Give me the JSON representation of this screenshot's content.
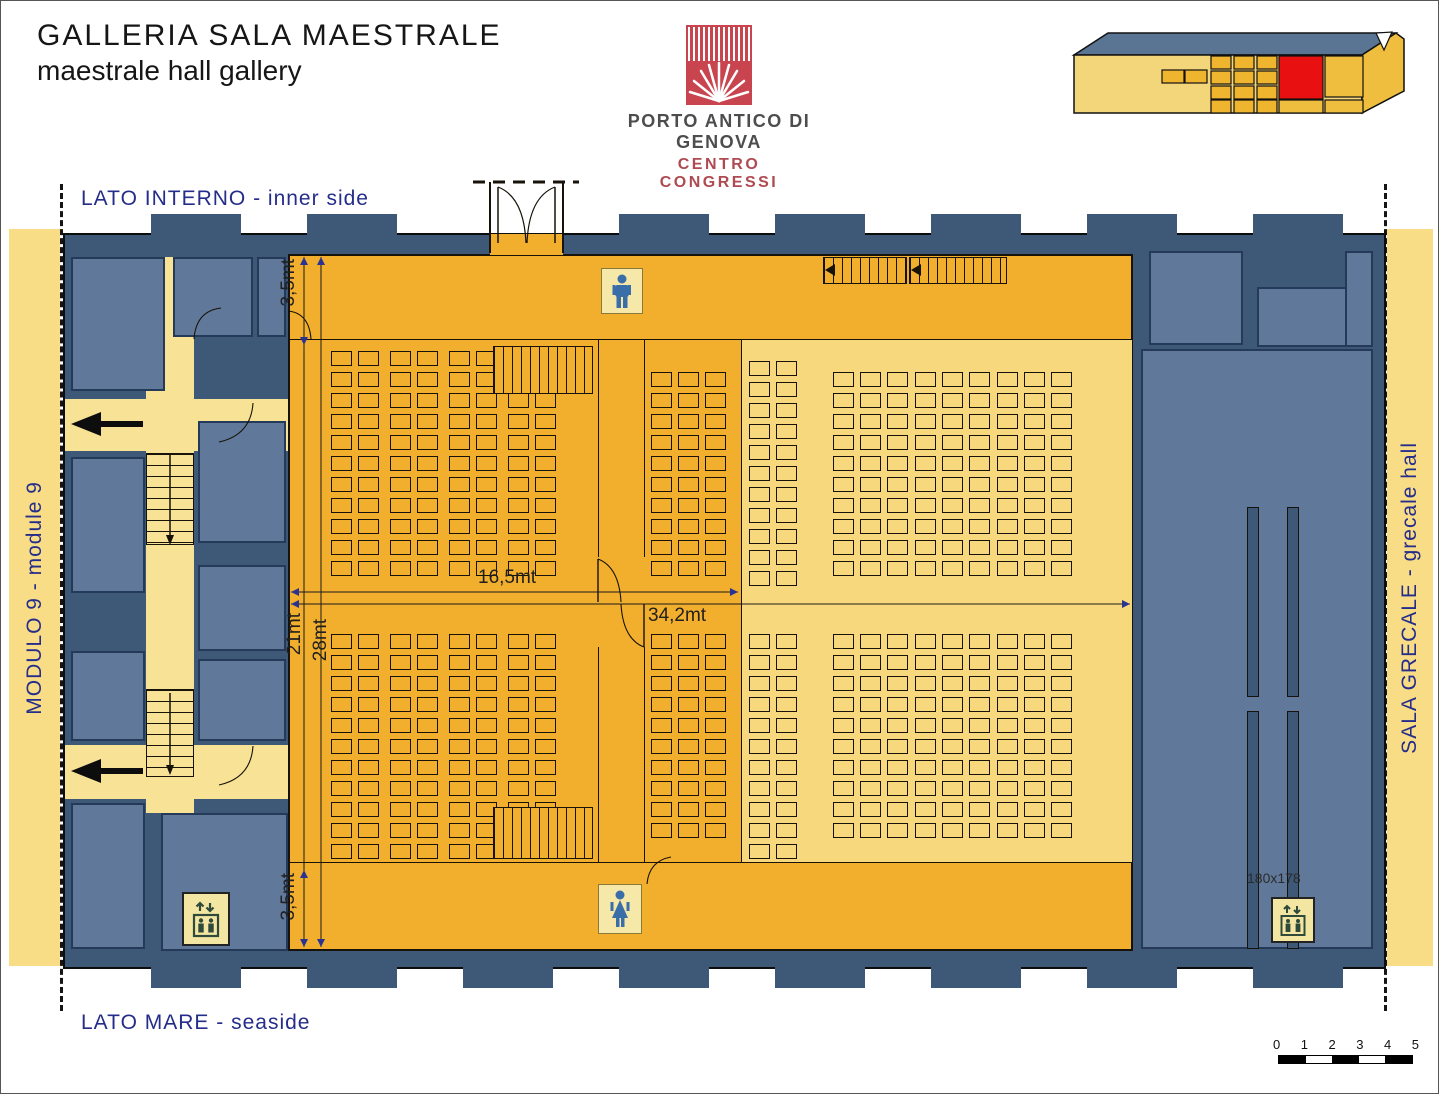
{
  "header": {
    "title": "GALLERIA SALA MAESTRALE",
    "subtitle": "maestrale hall gallery",
    "logo_line1": "PORTO ANTICO DI GENOVA",
    "logo_line2": "CENTRO CONGRESSI"
  },
  "labels": {
    "top": "LATO INTERNO - inner side",
    "bottom": "LATO MARE - seaside",
    "left": "MODULO 9 - module 9",
    "right": "SALA GRECALE - grecale hall"
  },
  "dims": {
    "top35": "3,5mt",
    "h21": "21mt",
    "h28": "28mt",
    "w165": "16,5mt",
    "w342": "34,2mt",
    "bottom35": "3,5mt",
    "elevator": "180x178"
  },
  "scalebar": {
    "ticks": [
      "0",
      "1",
      "2",
      "3",
      "4",
      "5"
    ]
  },
  "colors": {
    "wall": "#3E5878",
    "room": "#60789A",
    "hall_orange": "#F2AF2E",
    "seating_light": "#F8D87D",
    "side_strip": "#F8DC86",
    "corridor_yellow": "#F8E296",
    "label_navy": "#252D8A",
    "logo_red": "#C8444F",
    "logo_text_red": "#AF4A52",
    "locator_highlight_red": "#E81010",
    "roof_blue": "#5A7494",
    "wc_figure_blue": "#3A6EA8"
  },
  "icons": {
    "men_wc": "man silhouette in yellow box",
    "women_wc": "woman silhouette in yellow box",
    "elevator": "up-down arrows above cabin with two figures",
    "exit_arrow": "thick black arrow pointing left",
    "stairs": "hatched run with direction arrow",
    "logo_mark": "red square with white stripes and starburst",
    "building_locator": "isometric building with red highlighted module"
  },
  "floorplan": {
    "seat_blocks": [
      {
        "cols": [
          330,
          357,
          389,
          416,
          448,
          475,
          507,
          534
        ],
        "y": 350,
        "count": 11,
        "pitch": 21,
        "w": 21,
        "h": 15,
        "fill": "#F2AF2E"
      },
      {
        "cols": [
          650,
          677,
          704
        ],
        "y": 371,
        "count": 10,
        "pitch": 21,
        "w": 21,
        "h": 15,
        "fill": "#F2AF2E"
      },
      {
        "cols": [
          330,
          357,
          389,
          416,
          448,
          475,
          507,
          534
        ],
        "y": 633,
        "count": 11,
        "pitch": 21,
        "w": 21,
        "h": 15,
        "fill": "#F2AF2E"
      },
      {
        "cols": [
          650,
          677,
          704
        ],
        "y": 633,
        "count": 10,
        "pitch": 21,
        "w": 21,
        "h": 15,
        "fill": "#F2AF2E"
      },
      {
        "cols": [
          748,
          775
        ],
        "y": 360,
        "count": 11,
        "pitch": 21,
        "w": 21,
        "h": 15,
        "fill": "#F8D87D"
      },
      {
        "cols": [
          832,
          859,
          886
        ],
        "y": 371,
        "count": 10,
        "pitch": 21,
        "w": 21,
        "h": 15,
        "fill": "#F8D87D"
      },
      {
        "cols": [
          914,
          941,
          968
        ],
        "y": 371,
        "count": 10,
        "pitch": 21,
        "w": 21,
        "h": 15,
        "fill": "#F8D87D"
      },
      {
        "cols": [
          996,
          1023,
          1050
        ],
        "y": 371,
        "count": 10,
        "pitch": 21,
        "w": 21,
        "h": 15,
        "fill": "#F8D87D"
      },
      {
        "cols": [
          748,
          775
        ],
        "y": 633,
        "count": 11,
        "pitch": 21,
        "w": 21,
        "h": 15,
        "fill": "#F8D87D"
      },
      {
        "cols": [
          832,
          859,
          886
        ],
        "y": 633,
        "count": 10,
        "pitch": 21,
        "w": 21,
        "h": 15,
        "fill": "#F8D87D"
      },
      {
        "cols": [
          914,
          941,
          968
        ],
        "y": 633,
        "count": 10,
        "pitch": 21,
        "w": 21,
        "h": 15,
        "fill": "#F8D87D"
      },
      {
        "cols": [
          996,
          1023,
          1050
        ],
        "y": 633,
        "count": 10,
        "pitch": 21,
        "w": 21,
        "h": 15,
        "fill": "#F8D87D"
      }
    ]
  }
}
